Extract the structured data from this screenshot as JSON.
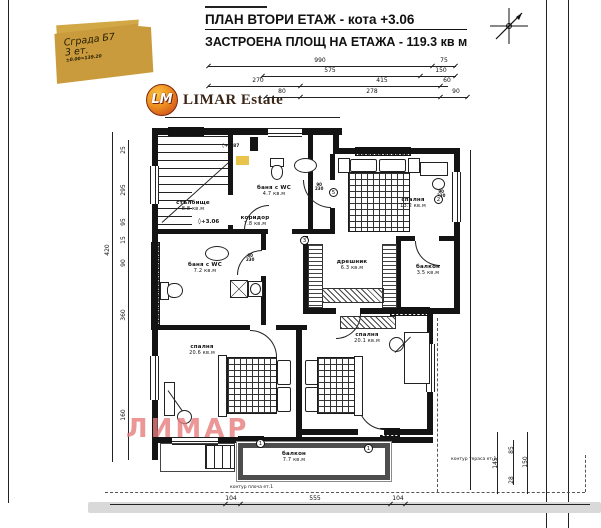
{
  "titles": {
    "line1": "ПЛАН ВТОРИ ЕТАЖ - кота +3.06",
    "line2": "ЗАСТРОЕНА ПЛОЩ НА ЕТАЖА - 119.3 кв м"
  },
  "stamp": {
    "building": "Сграда Б7",
    "floors": "3 ет.",
    "elevation": "±0.00=139.20"
  },
  "logo": {
    "monogram": "LM",
    "name": "LIMAR Estate"
  },
  "watermark": "ЛИМАР",
  "levels": {
    "floor": "+3.06",
    "stair": "+1.87"
  },
  "rooms": [
    {
      "label": "стълбище",
      "area": "8.8 кв.м"
    },
    {
      "label": "баня с WC",
      "area": "4.7 кв.м"
    },
    {
      "label": "коридор",
      "area": "7.8 кв.м"
    },
    {
      "label": "спалня",
      "area": "13.2 кв.м"
    },
    {
      "label": "дрешник",
      "area": "6.3 кв.м"
    },
    {
      "label": "балкон",
      "area": "3.5 кв.м"
    },
    {
      "label": "баня с WC",
      "area": "7.2 кв.м"
    },
    {
      "label": "спалня",
      "area": "20.6 кв.м"
    },
    {
      "label": "спалня",
      "area": "20.1 кв.м"
    },
    {
      "label": "балкон",
      "area": "7.7 кв.м"
    }
  ],
  "dim_labels": [
    {
      "t": "990",
      "x": 320,
      "y": 61
    },
    {
      "t": "75",
      "x": 444,
      "y": 61
    },
    {
      "t": "575",
      "x": 330,
      "y": 71
    },
    {
      "t": "150",
      "x": 441,
      "y": 71
    },
    {
      "t": "270",
      "x": 258,
      "y": 81
    },
    {
      "t": "415",
      "x": 382,
      "y": 81
    },
    {
      "t": "60",
      "x": 447,
      "y": 81
    },
    {
      "t": "80",
      "x": 282,
      "y": 92
    },
    {
      "t": "278",
      "x": 372,
      "y": 92
    },
    {
      "t": "90",
      "x": 456,
      "y": 92
    },
    {
      "t": "420",
      "x": 108,
      "y": 250,
      "r": 1
    },
    {
      "t": "25",
      "x": 124,
      "y": 150,
      "r": 1
    },
    {
      "t": "295",
      "x": 124,
      "y": 190,
      "r": 1
    },
    {
      "t": "95",
      "x": 124,
      "y": 222,
      "r": 1
    },
    {
      "t": "15",
      "x": 124,
      "y": 240,
      "r": 1
    },
    {
      "t": "90",
      "x": 124,
      "y": 263,
      "r": 1
    },
    {
      "t": "360",
      "x": 124,
      "y": 315,
      "r": 1
    },
    {
      "t": "160",
      "x": 124,
      "y": 415,
      "r": 1
    },
    {
      "t": "104",
      "x": 231,
      "y": 499
    },
    {
      "t": "555",
      "x": 315,
      "y": 499
    },
    {
      "t": "104",
      "x": 398,
      "y": 499
    },
    {
      "t": "145",
      "x": 496,
      "y": 463,
      "r": 1
    },
    {
      "t": "85",
      "x": 512,
      "y": 450,
      "r": 1
    },
    {
      "t": "28",
      "x": 512,
      "y": 480,
      "r": 1
    },
    {
      "t": "150",
      "x": 526,
      "y": 462,
      "r": 1
    }
  ],
  "door_sizes": [
    {
      "w": "90",
      "h": "230",
      "x": 315,
      "y": 183
    },
    {
      "w": "90",
      "h": "230",
      "x": 437,
      "y": 190
    },
    {
      "w": "80",
      "h": "230",
      "x": 246,
      "y": 254
    }
  ],
  "tags": [
    {
      "n": "5",
      "x": 329,
      "y": 188
    },
    {
      "n": "3",
      "x": 300,
      "y": 236
    },
    {
      "n": "2",
      "x": 434,
      "y": 195
    },
    {
      "n": "1",
      "x": 256,
      "y": 439
    },
    {
      "n": "1",
      "x": 364,
      "y": 444
    }
  ],
  "annotations": [
    {
      "t": "контур тераса ет.1",
      "x": 451,
      "y": 457
    },
    {
      "t": "контур плоча ет.1",
      "x": 230,
      "y": 485
    }
  ],
  "colors": {
    "stamp_gold": "#d2a847",
    "watermark_pink": "#e77d7d",
    "plan_line": "#141414",
    "terrace_wall": "#4d4d4d",
    "logo_orange": "#ee8f1f",
    "highlight_yellow": "#e9c44d"
  }
}
